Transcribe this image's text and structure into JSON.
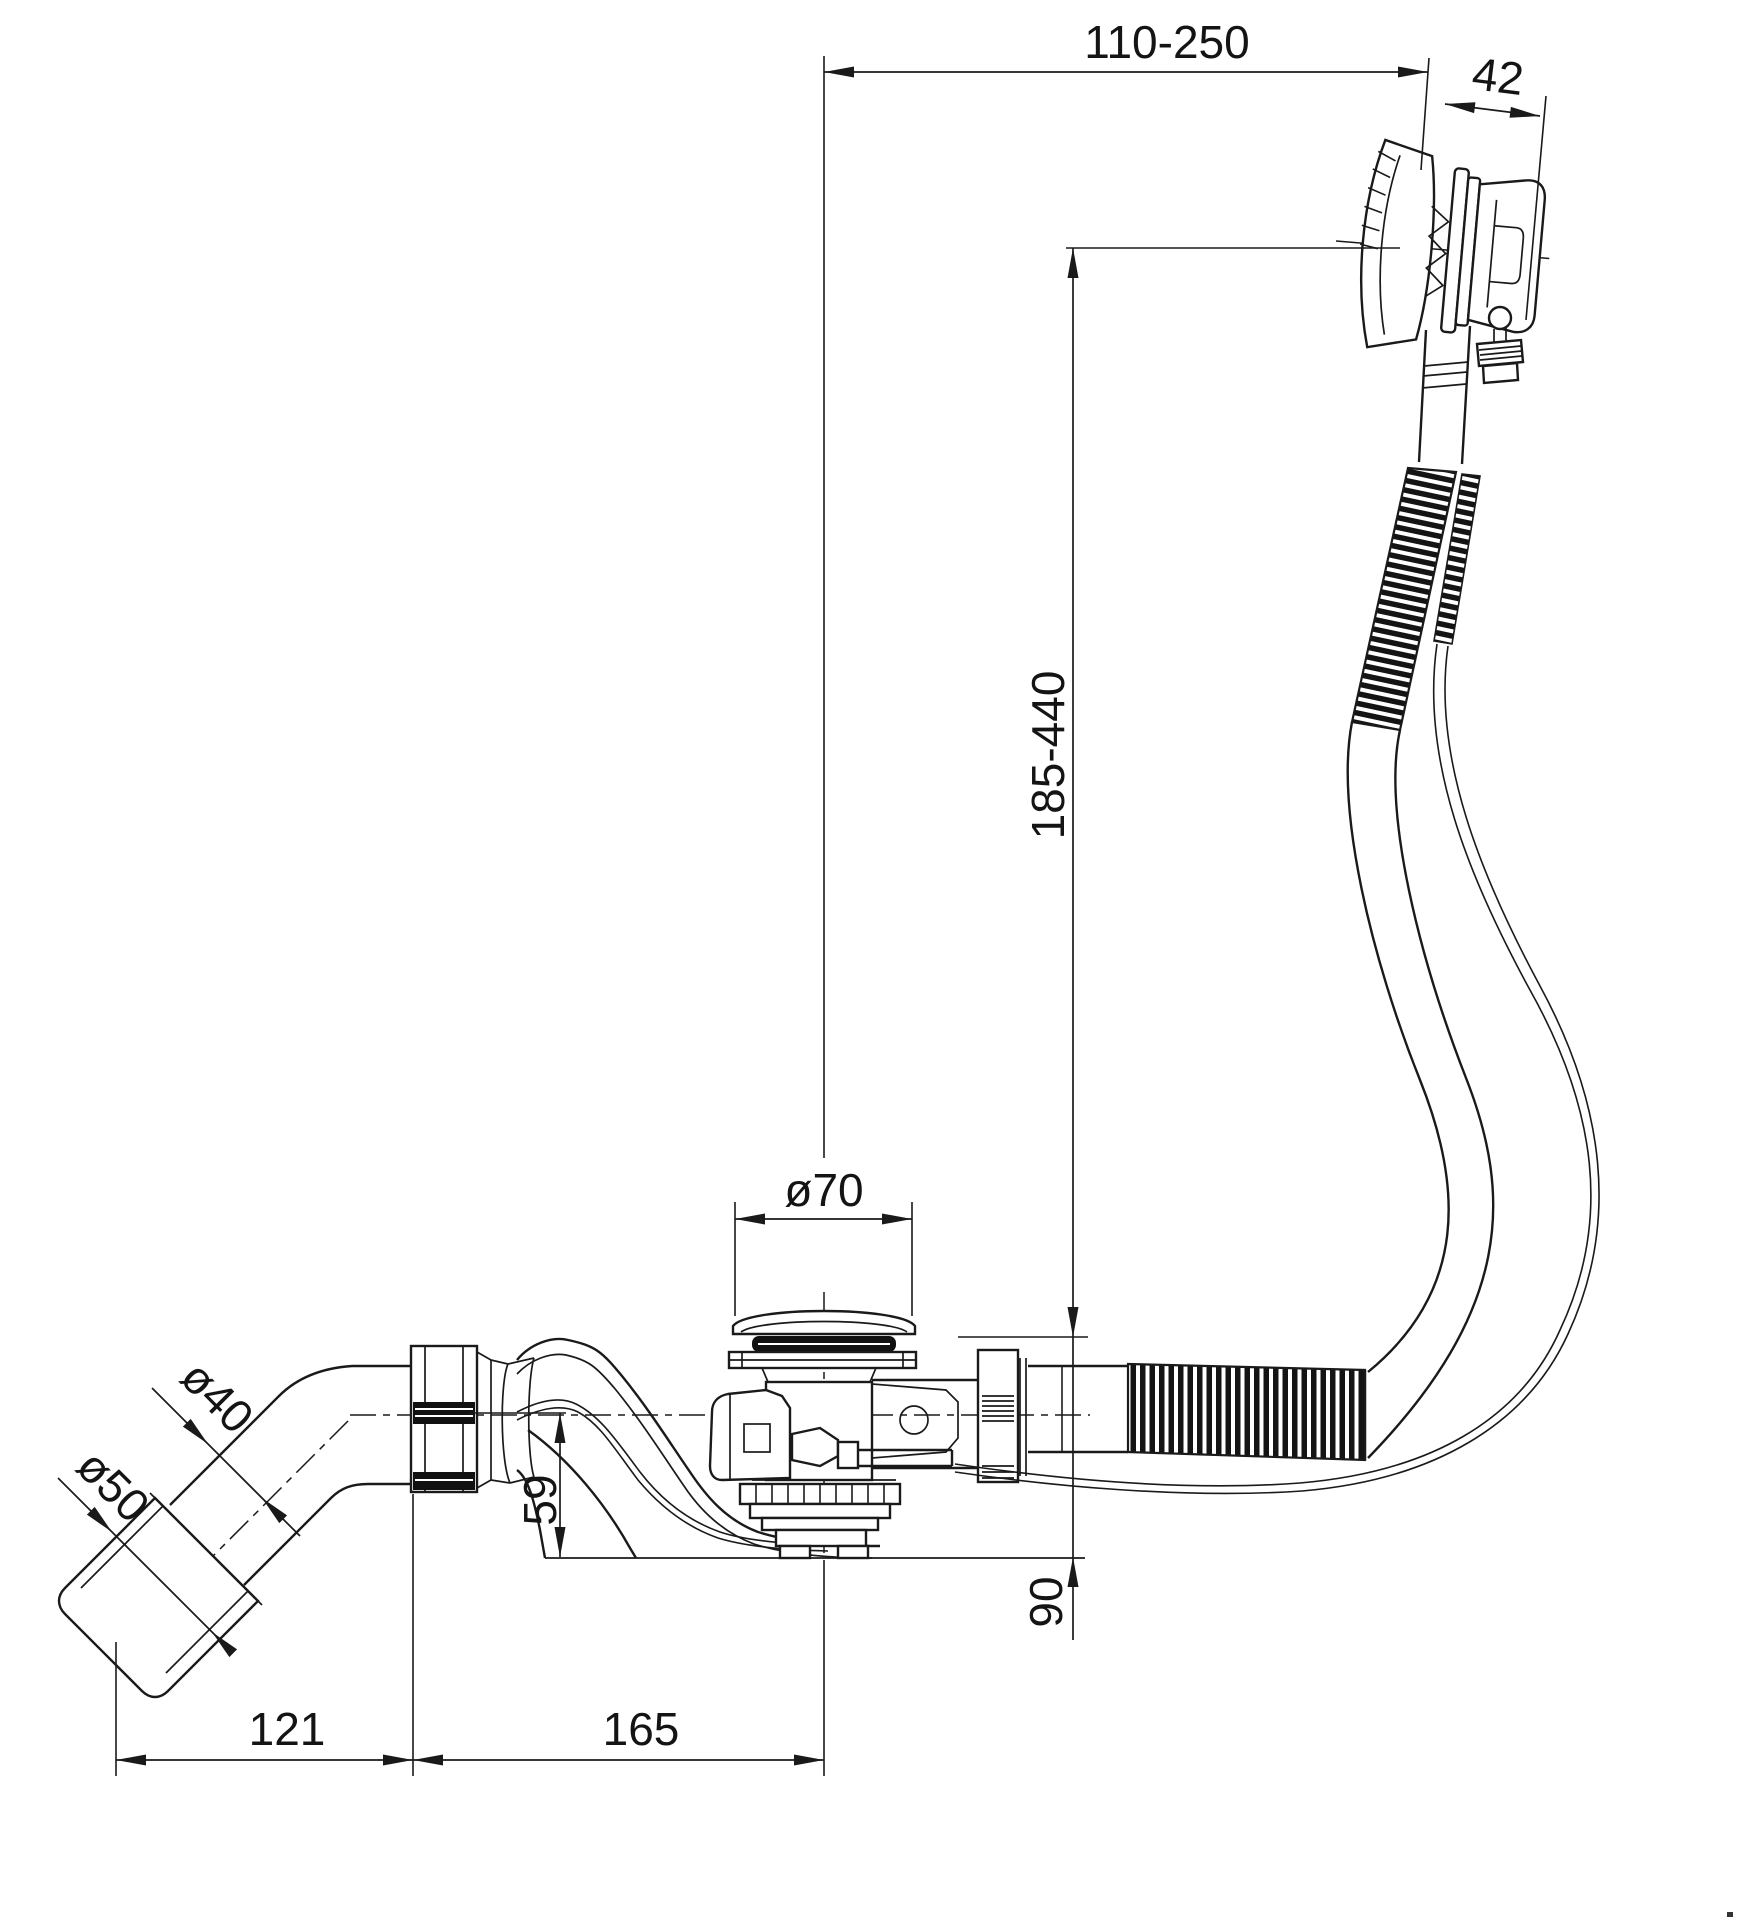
{
  "drawing": {
    "kind": "technical line drawing",
    "colors": {
      "line": "#1a1a1a",
      "seal_fill": "#111111",
      "background": "#ffffff"
    },
    "dimensions": {
      "horizontal_reach": "110-250",
      "knob_depth": "42",
      "cable_run_height": "185-440",
      "plug_diameter": "ø70",
      "elbow_diameter": "ø40",
      "outlet_sleeve_diameter": "ø50",
      "waste_body_height": "59",
      "overflow_base_height": "90",
      "elbow_horizontal_offset": "121",
      "waste_to_overflow_offset": "165"
    }
  }
}
